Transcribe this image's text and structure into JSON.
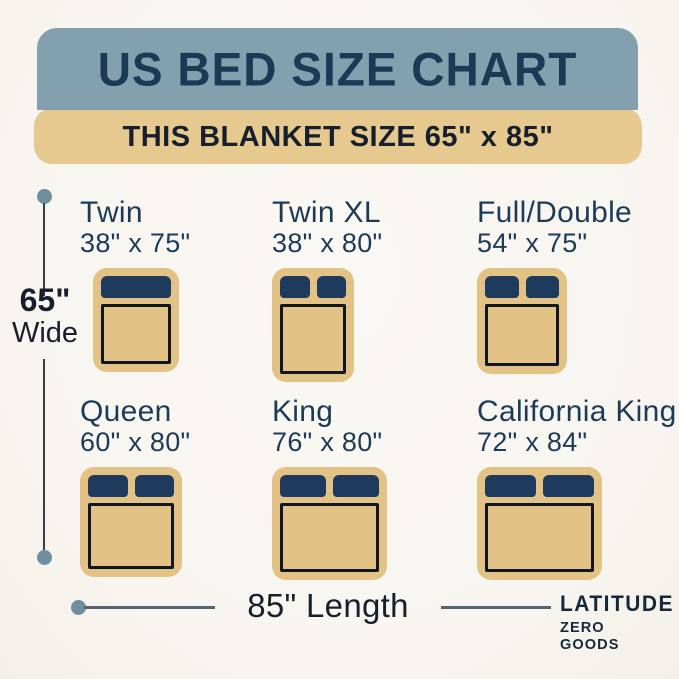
{
  "header": {
    "title": "US BED SIZE CHART",
    "subtitle": "THIS BLANKET SIZE 65\" x 85\""
  },
  "beds": [
    {
      "name": "Twin",
      "size": "38\" x 75\"",
      "pillows": 1
    },
    {
      "name": "Twin XL",
      "size": "38\" x 80\"",
      "pillows": 2
    },
    {
      "name": "Full/Double",
      "size": "54\" x 75\"",
      "pillows": 2
    },
    {
      "name": "Queen",
      "size": "60\" x 80\"",
      "pillows": 2
    },
    {
      "name": "King",
      "size": "76\" x 80\"",
      "pillows": 2
    },
    {
      "name": "California King",
      "size": "72\" x 84\"",
      "pillows": 2
    }
  ],
  "dimensions": {
    "width_value": "65\"",
    "width_word": "Wide",
    "length_label": "85\" Length"
  },
  "brand": {
    "line1": "LATITUDE",
    "line2": "ZERO GOODS"
  },
  "colors": {
    "background": "#f8f5f0",
    "header_bg": "#82a0ae",
    "banner_bg": "#e6c98f",
    "bed_fill": "#e2c285",
    "pillow": "#1e3a5c",
    "outline": "#101722",
    "heading_text": "#1b3a55",
    "label_text": "#1d3b56",
    "dark_text": "#161f2b",
    "dot": "#6f8fa0",
    "line": "#55656f"
  }
}
